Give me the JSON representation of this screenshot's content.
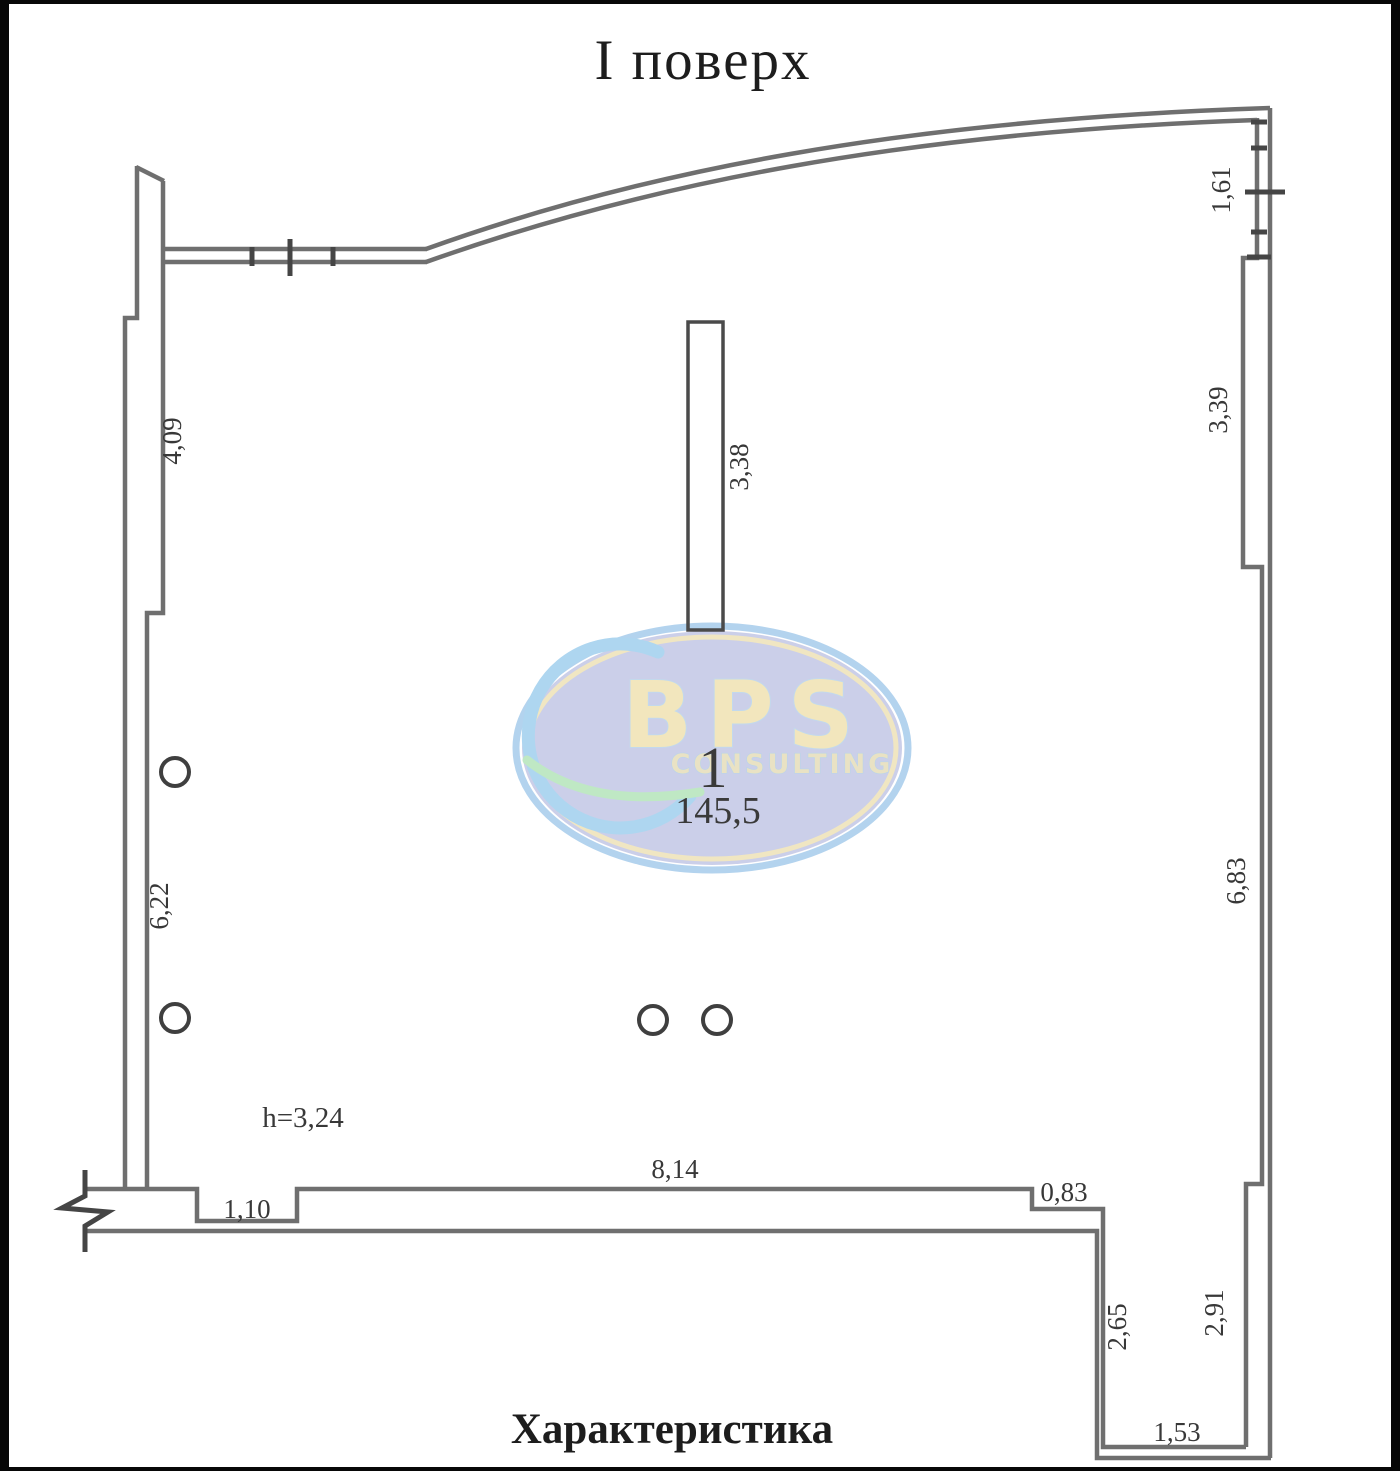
{
  "page": {
    "title": "І поверх",
    "footer_heading": "Характеристика"
  },
  "room": {
    "number": "1",
    "area": "145,5",
    "ceiling_height": "h=3,24"
  },
  "dimensions": {
    "left_upper": "4,09",
    "left_lower": "6,22",
    "partition": "3,38",
    "right_window": "1,61",
    "right_upper": "3,39",
    "right_lower": "6,83",
    "bottom_opening_left": "1,10",
    "bottom_length": "8,14",
    "bottom_opening_right": "0,83",
    "annex_left": "2,65",
    "annex_right": "2,91",
    "annex_width": "1,53"
  },
  "watermark": {
    "brand": "BPS",
    "subtitle": "CONSULTING",
    "colors": {
      "ellipse_fill": "#cbcfe9",
      "ring_blue": "#b3d3ee",
      "ring_yellow": "#f0e6c2",
      "letters": "#f2e6bd",
      "swirl_blue": "#aed6f0",
      "swirl_green": "#bfe8c4"
    }
  },
  "plan_colors": {
    "wall_line": "#6f6f6f",
    "detail_line": "#3c3c3c",
    "label_text": "#383838"
  }
}
